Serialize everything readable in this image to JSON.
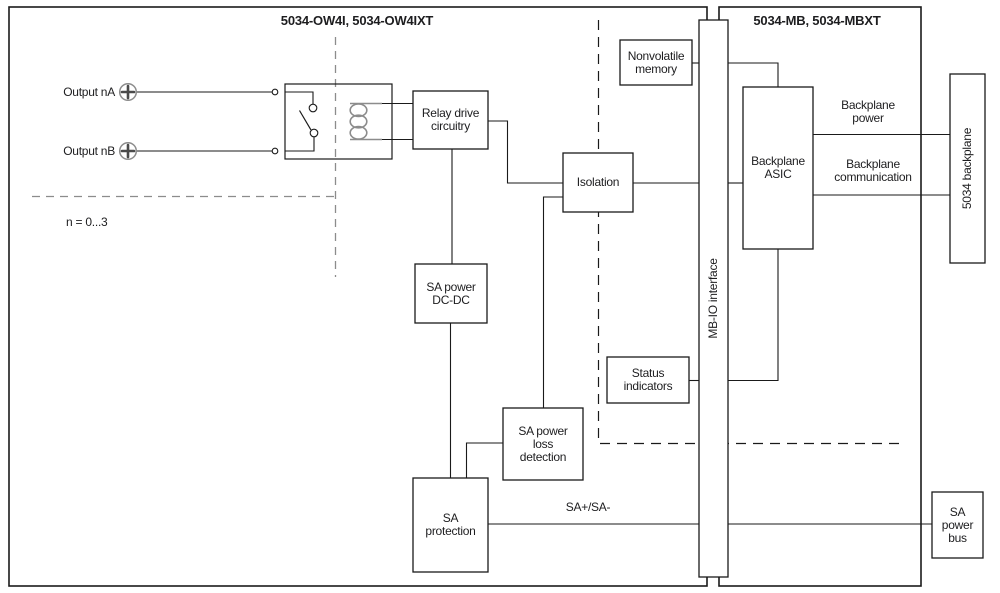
{
  "diagram": {
    "title_left": "5034-OW4I, 5034-OW4IXT",
    "title_right": "5034-MB, 5034-MBXT",
    "output_a": "Output nA",
    "output_b": "Output nB",
    "range_note": "n = 0...3",
    "sa_line_label": "SA+/SA-"
  },
  "boxes": {
    "nonvolatile_memory": {
      "l1": "Nonvolatile",
      "l2": "memory"
    },
    "relay_drive": {
      "l1": "Relay drive",
      "l2": "circuitry"
    },
    "isolation": {
      "l1": "Isolation"
    },
    "sa_power_dcdc": {
      "l1": "SA power",
      "l2": "DC-DC"
    },
    "status_indicators": {
      "l1": "Status",
      "l2": "indicators"
    },
    "sa_power_loss_detection": {
      "l1": "SA power",
      "l2": "loss",
      "l3": "detection"
    },
    "sa_protection": {
      "l1": "SA",
      "l2": "protection"
    },
    "backplane_asic": {
      "l1": "Backplane",
      "l2": "ASIC"
    },
    "mb_io_interface": {
      "label": "MB-IO interface"
    },
    "backplane_5034": {
      "label": "5034 backplane"
    },
    "sa_power_bus": {
      "l1": "SA",
      "l2": "power",
      "l3": "bus"
    }
  },
  "bus_labels": {
    "backplane_power": {
      "l1": "Backplane",
      "l2": "power"
    },
    "backplane_communication": {
      "l1": "Backplane",
      "l2": "communication"
    }
  },
  "colors": {
    "line": "#1a1a1a",
    "muted": "#8c8c8c",
    "text": "#1d1d1f",
    "background": "#ffffff"
  }
}
